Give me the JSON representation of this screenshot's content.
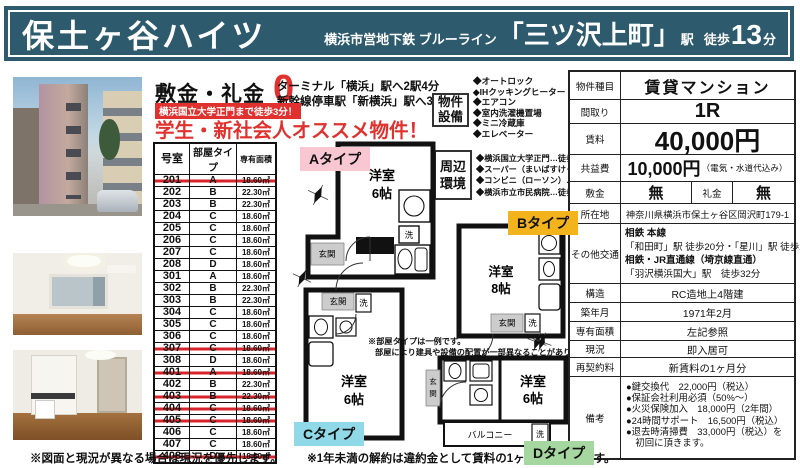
{
  "header": {
    "building_name": "保土ヶ谷ハイツ",
    "line_name": "横浜市営地下鉄 ブルーライン",
    "station": "「三ツ沢上町」",
    "station_suffix": "駅",
    "walk_prefix": "徒歩",
    "walk_minutes": "13",
    "walk_unit": "分"
  },
  "promo": {
    "deposit_label": "敷金・礼金",
    "deposit_value": "0",
    "terminal_line1": "ターミナル「横浜」駅へ2駅4分",
    "terminal_line2": "新幹線停車駅「新横浜」駅へ3駅7分",
    "university_badge": "横浜国立大学正門まで徒歩3分！",
    "headline": "学生・新社会人オススメ物件！"
  },
  "facilities": {
    "label_line1": "物件",
    "label_line2": "設備",
    "items": [
      "◆オートロック",
      "◆IHクッキングヒーター",
      "◆エアコン",
      "◆室内洗濯機置場",
      "◆ミニ冷蔵庫",
      "◆エレベーター"
    ]
  },
  "surroundings": {
    "label_line1": "周辺",
    "label_line2": "環境",
    "items": [
      "◆横浜国立大学正門…徒歩3分",
      "◆スーパー（まいばすけっと）…徒歩2分",
      "◆コンビニ（ローソン）…徒歩3分",
      "◆横浜市立市民病院…徒歩5分"
    ]
  },
  "room_table": {
    "headers": [
      "号室",
      "部屋タイプ",
      "専有面積"
    ],
    "rows": [
      {
        "no": "201",
        "type": "A",
        "area": "18.60㎡",
        "closed": true
      },
      {
        "no": "202",
        "type": "B",
        "area": "22.30㎡",
        "closed": false
      },
      {
        "no": "203",
        "type": "B",
        "area": "22.30㎡",
        "closed": false
      },
      {
        "no": "204",
        "type": "C",
        "area": "18.60㎡",
        "closed": false
      },
      {
        "no": "205",
        "type": "C",
        "area": "18.60㎡",
        "closed": false
      },
      {
        "no": "206",
        "type": "C",
        "area": "18.60㎡",
        "closed": false
      },
      {
        "no": "207",
        "type": "C",
        "area": "18.60㎡",
        "closed": false
      },
      {
        "no": "208",
        "type": "D",
        "area": "18.60㎡",
        "closed": false
      },
      {
        "no": "301",
        "type": "A",
        "area": "18.60㎡",
        "closed": false
      },
      {
        "no": "302",
        "type": "B",
        "area": "22.30㎡",
        "closed": false
      },
      {
        "no": "303",
        "type": "B",
        "area": "22.30㎡",
        "closed": false
      },
      {
        "no": "304",
        "type": "C",
        "area": "18.60㎡",
        "closed": false
      },
      {
        "no": "305",
        "type": "C",
        "area": "18.60㎡",
        "closed": false
      },
      {
        "no": "306",
        "type": "C",
        "area": "18.60㎡",
        "closed": false
      },
      {
        "no": "307",
        "type": "C",
        "area": "18.60㎡",
        "closed": true
      },
      {
        "no": "308",
        "type": "D",
        "area": "18.60㎡",
        "closed": false
      },
      {
        "no": "401",
        "type": "A",
        "area": "18.60㎡",
        "closed": true
      },
      {
        "no": "402",
        "type": "B",
        "area": "22.30㎡",
        "closed": false
      },
      {
        "no": "403",
        "type": "B",
        "area": "22.30㎡",
        "closed": true
      },
      {
        "no": "404",
        "type": "C",
        "area": "18.60㎡",
        "closed": true
      },
      {
        "no": "405",
        "type": "C",
        "area": "18.60㎡",
        "closed": true
      },
      {
        "no": "406",
        "type": "C",
        "area": "18.60㎡",
        "closed": false
      },
      {
        "no": "407",
        "type": "C",
        "area": "18.60㎡",
        "closed": false
      },
      {
        "no": "408",
        "type": "D",
        "area": "18.60㎡",
        "closed": true
      }
    ]
  },
  "plans": {
    "label_a": "Aタイプ",
    "label_b": "Bタイプ",
    "label_c": "Cタイプ",
    "label_d": "Dタイプ",
    "room": "洋室",
    "jo6": "6帖",
    "jo8": "8帖",
    "genkan": "玄関",
    "genkan_v1": "玄",
    "genkan_v2": "関",
    "laundry": "洗",
    "balcony": "バルコニー",
    "note_line1": "※部屋タイプは一例です。",
    "note_line2": "部屋により建具や設備の配置が一部異なることがあります。"
  },
  "spec": {
    "property_type_label": "物件種目",
    "property_type": "賃貸マンション",
    "layout_label": "間取り",
    "layout": "1R",
    "rent_label": "賃料",
    "rent": "40,000円",
    "fee_label": "共益費",
    "fee": "10,000円",
    "fee_note": "（電気・水道代込み）",
    "deposit_label": "敷金",
    "deposit": "無",
    "key_money_label": "礼金",
    "key_money": "無",
    "address_label": "所在地",
    "address": "神奈川県横浜市保土ヶ谷区岡沢町179-1",
    "access_label": "その他交通",
    "access_lines": [
      "相鉄 本線",
      "「和田町」駅 徒歩20分・「星川」駅 徒歩24分",
      "相鉄・JR直通線（埼京線直通）",
      "「羽沢横浜国大」駅　徒歩32分"
    ],
    "structure_label": "構造",
    "structure": "RC造地上4階建",
    "built_label": "築年月",
    "built": "1971年2月",
    "area_label": "専有面積",
    "area": "左記参照",
    "status_label": "現況",
    "status": "即入居可",
    "renewal_label": "再契約料",
    "renewal": "新賃料の1ヶ月分",
    "remarks_label": "備考",
    "remarks": [
      "●鍵交換代　22,000円（税込）",
      "●保証会社利用必須（50%～）",
      "●火災保険加入　18,000円（2年間）",
      "●24時間サポート　16,500円（税込）",
      "●退去時清掃費　33,000円（税込）を",
      "　初回に頂きます。"
    ]
  },
  "footer": {
    "note1": "※図面と現況が異なる場合は現況を優先します。",
    "note2": "※1年未満の解約は違約金として賃料の1ヶ月分を頂きます。"
  },
  "colors": {
    "header_bg": "#2d5a6c",
    "accent_red": "#e0312e",
    "label_a_bg": "#f8c7d2",
    "label_b_bg": "#f3b31c",
    "label_c_bg": "#8fd9e9",
    "label_d_bg": "#a6d7a0"
  }
}
